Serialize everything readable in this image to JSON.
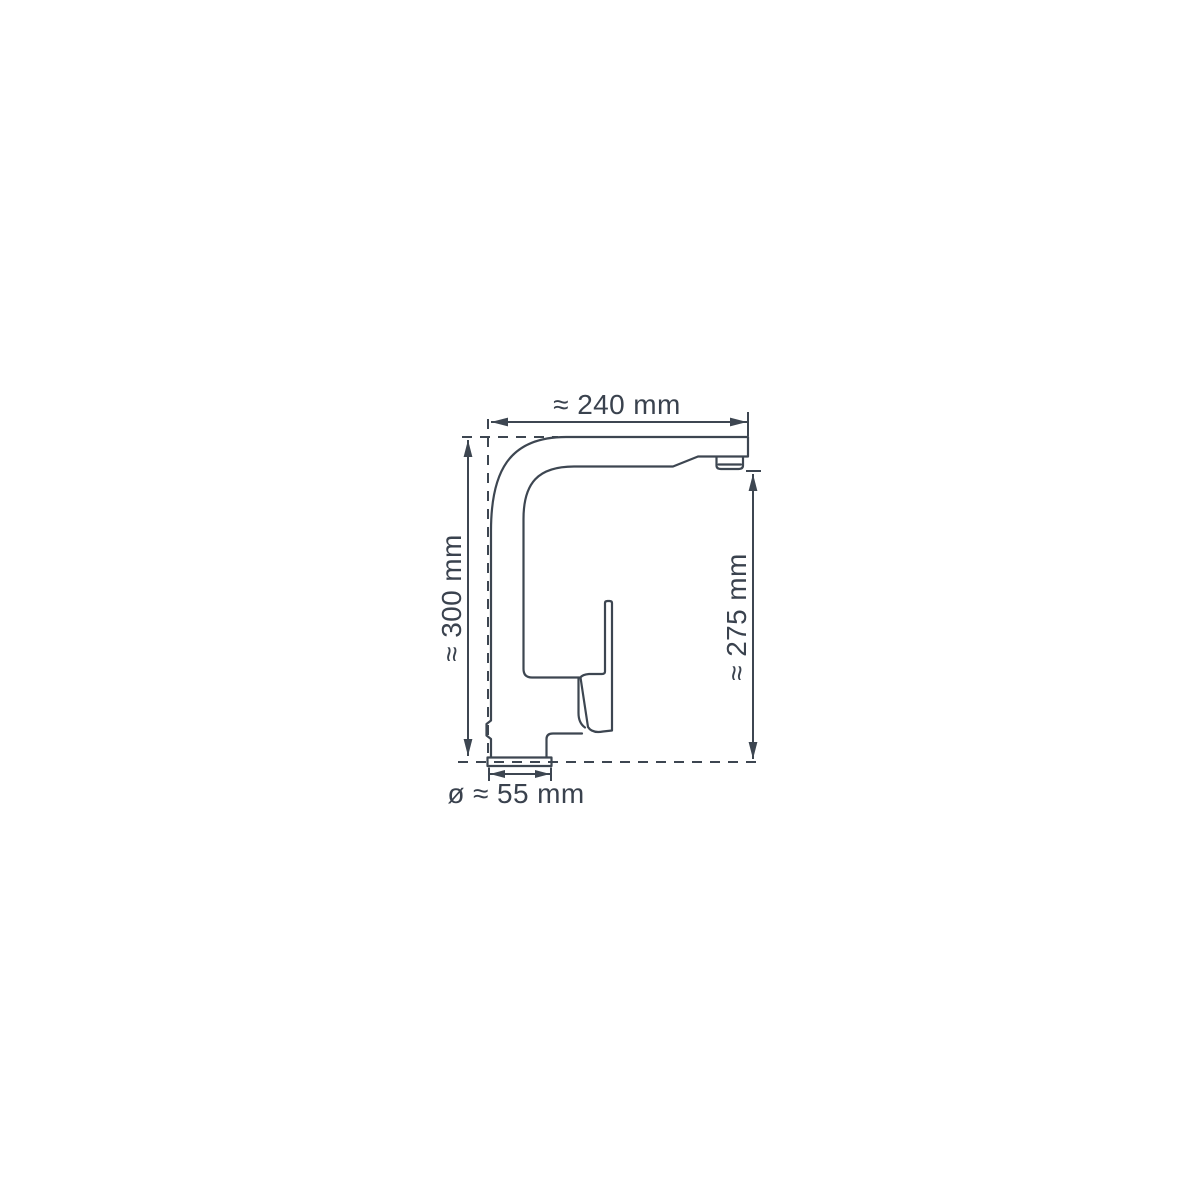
{
  "page": {
    "background": "#ffffff"
  },
  "drawing": {
    "line_color": "#3d4651",
    "text_color": "#3a424e",
    "labels": {
      "spout_reach_width": "≈ 240 mm",
      "total_height": "≈ 300 mm",
      "spout_outlet_height": "≈ 275 mm",
      "base_diameter": "ø ≈ 55 mm"
    }
  }
}
